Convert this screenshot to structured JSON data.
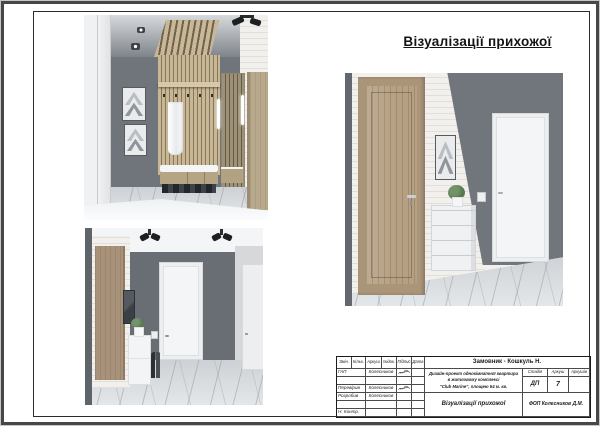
{
  "page_title": "Візуалізації прихожої",
  "title_block": {
    "customer": "Замовник - Кошкуль Н.",
    "project_line1": "Дизайн-проект однокімнатної квартири",
    "project_line2": "в житловому комплексі",
    "project_line3": "\"Club Marine\", площею 54 м. кв.",
    "columns": {
      "change": "Змін.",
      "qty": "Кільк.",
      "sheet": "Аркуш",
      "doc": "№док.",
      "signature": "Підпис",
      "date": "Дата"
    },
    "rows": [
      {
        "role": "ГАП",
        "name": "Колесников"
      },
      {
        "role": "Перевірив",
        "name": "Колесников"
      },
      {
        "role": "Розробив",
        "name": "Колесников"
      },
      {
        "role": "Н. Контр.",
        "name": ""
      }
    ],
    "stage_label": "Стадія",
    "sheet_label": "Аркуш",
    "sheets_label": "Аркушів",
    "stage_value": "ДП",
    "sheet_value": "7",
    "sheets_value": "",
    "doc_title": "Візуалізації прихожої",
    "organization": "ФОП Колесников Д.М."
  },
  "colors": {
    "wall_gray": "#6f747b",
    "wood": "#b5a083",
    "brick_white": "#f1f0ed",
    "marble_floor": "#d2d6d9",
    "frame_line": "#2b2b2b"
  }
}
